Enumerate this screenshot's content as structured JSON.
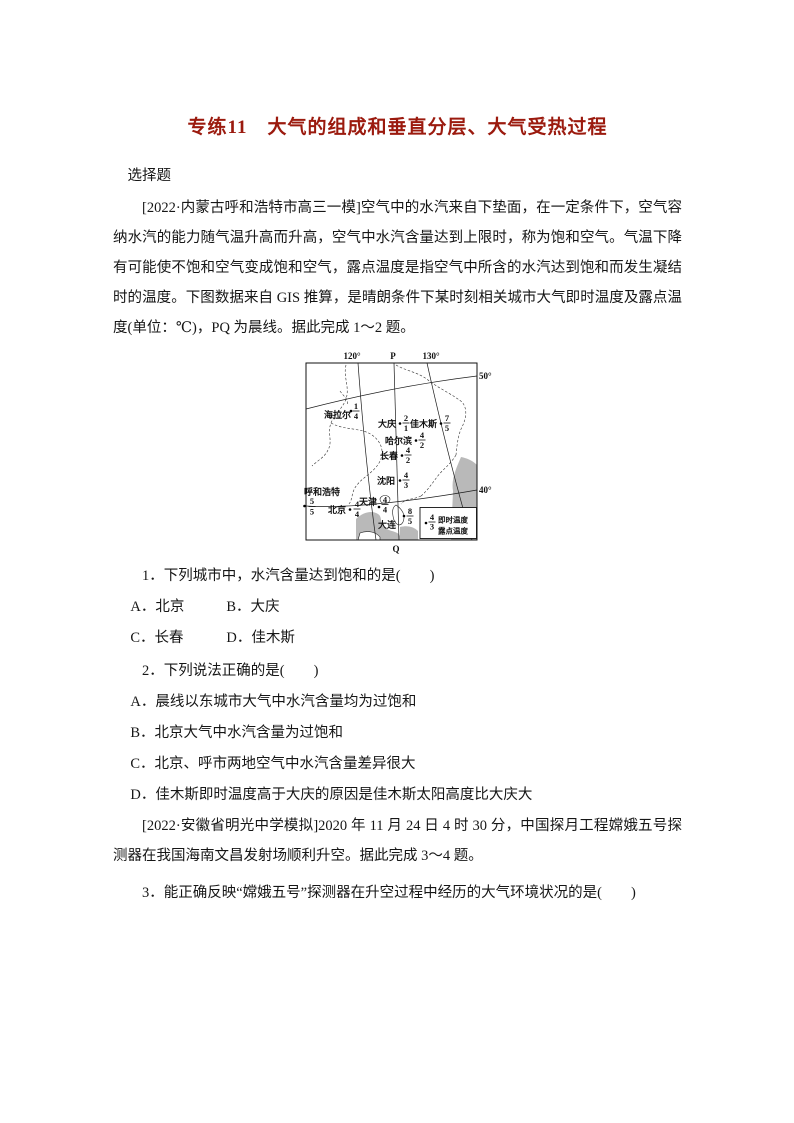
{
  "doc": {
    "title": "专练11　大气的组成和垂直分层、大气受热过程",
    "section_label": "选择题",
    "intro1": "[2022·内蒙古呼和浩特市高三一模]空气中的水汽来自下垫面，在一定条件下，空气容纳水汽的能力随气温升高而升高，空气中水汽含量达到上限时，称为饱和空气。气温下降有可能使不饱和空气变成饱和空气，露点温度是指空气中所含的水汽达到饱和而发生凝结时的温度。下图数据来自 GIS 推算，是晴朗条件下某时刻相关城市大气即时温度及露点温度(单位：℃)，PQ 为晨线。据此完成 1～2 题。",
    "questions": [
      {
        "stem": "1．下列城市中，水汽含量达到饱和的是(　　)",
        "option_rows": [
          [
            "A．北京",
            "B．大庆"
          ],
          [
            "C．长春",
            "D．佳木斯"
          ]
        ]
      },
      {
        "stem": "2．下列说法正确的是(　　)",
        "option_rows": [
          [
            "A．晨线以东城市大气中水汽含量均为过饱和"
          ],
          [
            "B．北京大气中水汽含量为过饱和"
          ],
          [
            "C．北京、呼市两地空气中水汽含量差异很大"
          ],
          [
            "D．佳木斯即时温度高于大庆的原因是佳木斯太阳高度比大庆大"
          ]
        ]
      },
      {
        "stem": "3．能正确反映“嫦娥五号”探测器在升空过程中经历的大气环境状况的是(　　)"
      }
    ],
    "intro2": "[2022·安徽省明光中学模拟]2020 年 11 月 24 日 4 时 30 分，中国探月工程嫦娥五号探测器在我国海南文昌发射场顺利升空。据此完成 3～4 题。"
  },
  "map": {
    "meridian_labels": [
      "120°",
      "P",
      "130°"
    ],
    "parallel_labels": [
      "50°",
      "40°"
    ],
    "q_label": "Q",
    "legend": {
      "sample_temp": "4",
      "sample_dew": "3",
      "temp_label": "即时温度",
      "dew_label": "露点温度"
    },
    "cities": [
      {
        "name": "海拉尔",
        "temp": "1",
        "dew": "4"
      },
      {
        "name": "大庆",
        "temp": "2",
        "dew": "1"
      },
      {
        "name": "佳木斯",
        "temp": "7",
        "dew": "5"
      },
      {
        "name": "哈尔滨",
        "temp": "4",
        "dew": "2"
      },
      {
        "name": "长春",
        "temp": "4",
        "dew": "2"
      },
      {
        "name": "沈阳",
        "temp": "4",
        "dew": "3"
      },
      {
        "name": "呼和浩特",
        "temp": "5",
        "dew": "5"
      },
      {
        "name": "北京",
        "temp": "4",
        "dew": "4"
      },
      {
        "name": "天津",
        "temp": "4",
        "dew": "4"
      },
      {
        "name": "大连",
        "temp": "8",
        "dew": "5"
      }
    ]
  }
}
